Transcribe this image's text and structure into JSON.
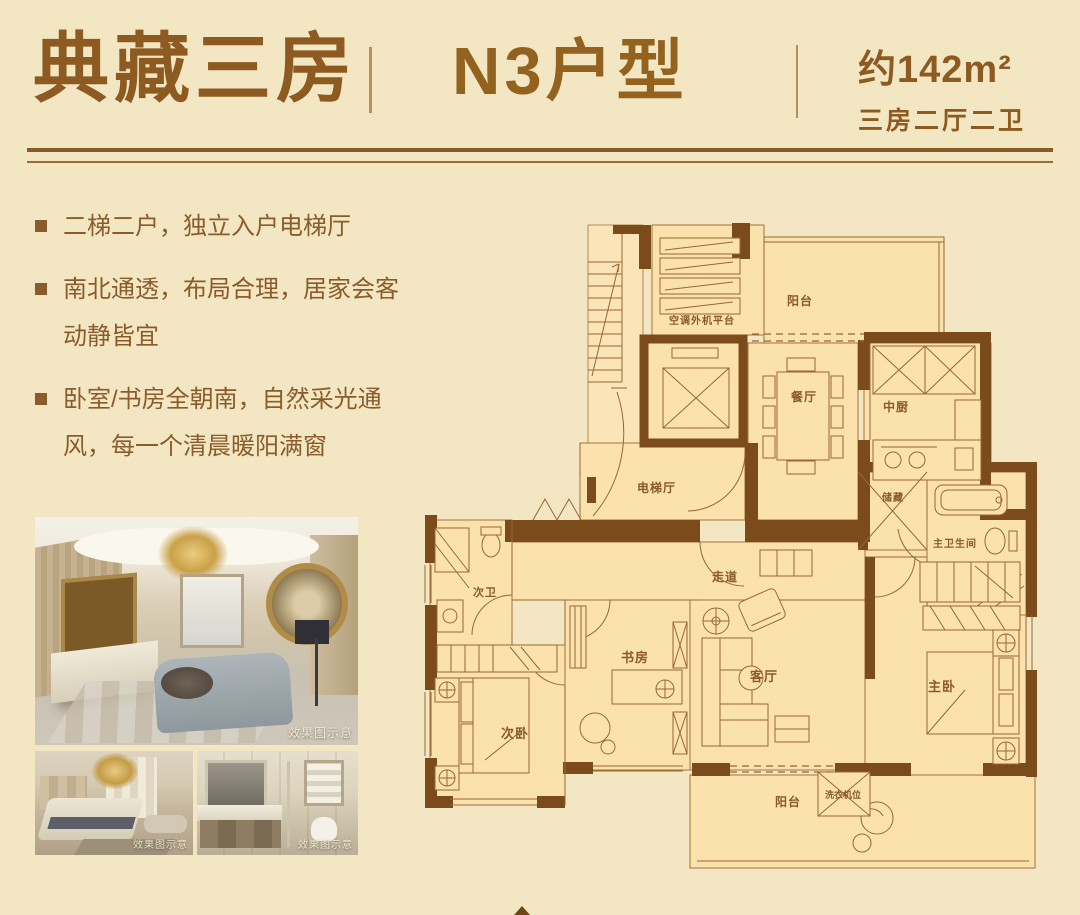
{
  "header": {
    "title": "典藏三房",
    "unit_name": "N3户型",
    "area": "约142m²",
    "spec": "三房二厅二卫"
  },
  "features": [
    "二梯二户，独立入户电梯厅",
    "南北通透，布局合理，居家会客动静皆宜",
    "卧室/书房全朝南，自然采光通风，每一个清晨暖阳满窗"
  ],
  "photos": [
    {
      "name": "living-room-rendering",
      "watermark": "效果图示意"
    },
    {
      "name": "bedroom-rendering",
      "watermark": "效果图示意"
    },
    {
      "name": "bathroom-rendering",
      "watermark": "效果图示意"
    }
  ],
  "floorplan": {
    "rooms": [
      {
        "id": "balcony-north",
        "label": "阳台"
      },
      {
        "id": "ac-platform",
        "label": "空调外机平台"
      },
      {
        "id": "dining",
        "label": "餐厅"
      },
      {
        "id": "kitchen",
        "label": "中厨"
      },
      {
        "id": "storage",
        "label": "储藏"
      },
      {
        "id": "master-bath",
        "label": "主卫生间"
      },
      {
        "id": "elevator-hall",
        "label": "电梯厅"
      },
      {
        "id": "second-bath",
        "label": "次卫"
      },
      {
        "id": "corridor",
        "label": "走道"
      },
      {
        "id": "study",
        "label": "书房"
      },
      {
        "id": "living",
        "label": "客厅"
      },
      {
        "id": "master-bedroom",
        "label": "主卧"
      },
      {
        "id": "second-bedroom",
        "label": "次卧"
      },
      {
        "id": "balcony-south",
        "label": "阳台"
      },
      {
        "id": "washer",
        "label": "洗衣机位"
      }
    ]
  },
  "colors": {
    "background": "#f3e6c2",
    "accent_text": "#8a5a27",
    "wall": "#7b4b1c",
    "room_fill": "#fbe2ad"
  }
}
